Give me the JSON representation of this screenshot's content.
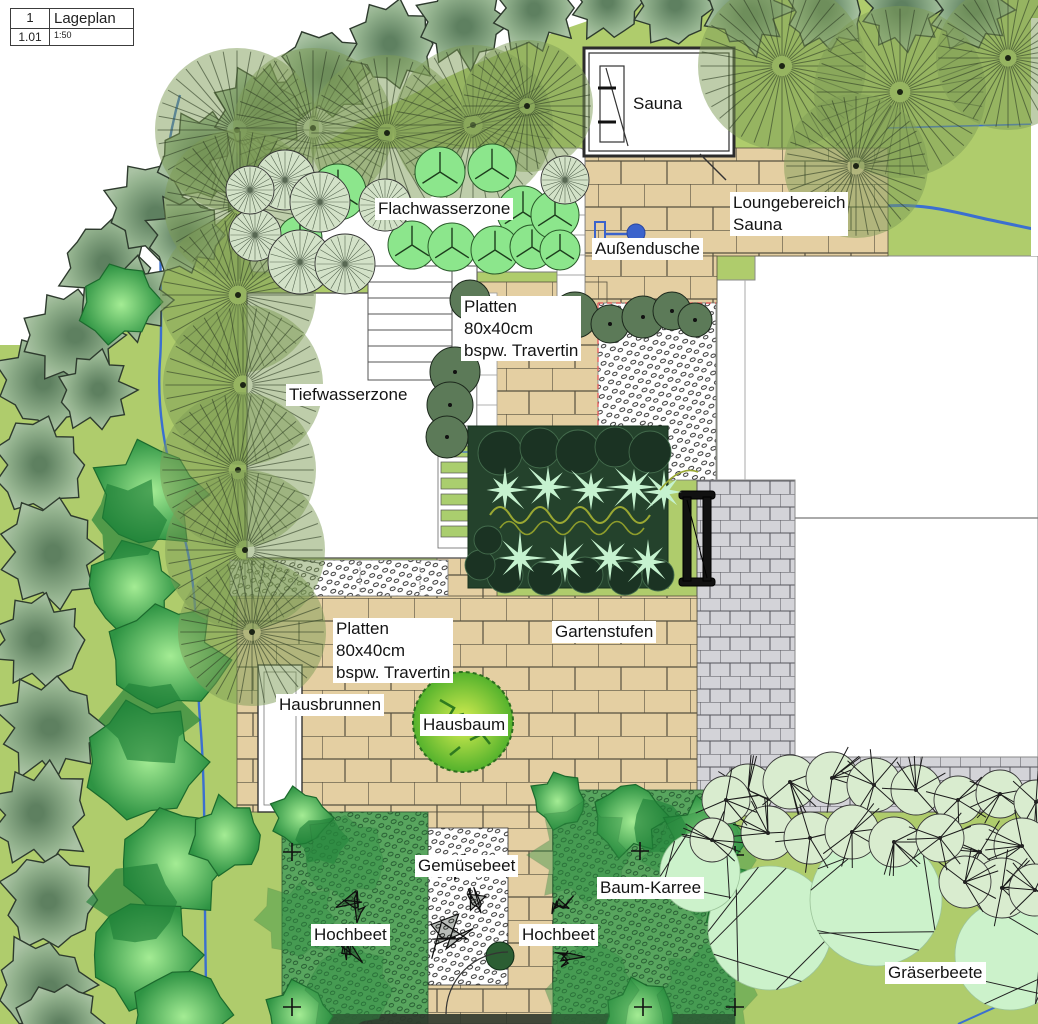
{
  "title_block": {
    "number": "1",
    "title": "Lageplan",
    "sheet": "1.01",
    "scale": "1:50"
  },
  "labels": {
    "flachwasserzone": "Flachwasserzone",
    "sauna": "Sauna",
    "loungebereich_sauna": "Loungebereich\nSauna",
    "aussendusche": "Außendusche",
    "platten_oben": "Platten\n80x40cm\nbspw. Travertin",
    "tiefwasserzone": "Tiefwasserzone",
    "gartenstufen": "Gartenstufen",
    "platten_terrasse": "Platten\n80x40cm\nbspw. Travertin",
    "hausbrunnen": "Hausbrunnen",
    "hausbaum": "Hausbaum",
    "gemuesebeet": "Gemüsebeet",
    "baum_karree": "Baum-Karree",
    "hochbeet_links": "Hochbeet",
    "hochbeet_rechts": "Hochbeet",
    "graeserbeete": "Gräserbeete"
  },
  "colors": {
    "lawn": "#afcc6c",
    "paving_tan": "#e4cfa2",
    "paving_gray": "#d4d4d8",
    "water": "#ffffff",
    "stream_blue": "#3b6fd0",
    "hedge_green": "#8fae8b",
    "shrub_green": "#3fae54",
    "fan_tree_olive": "#7d9b55",
    "planting_bed_dark": "#24422c",
    "mint_plant": "#bff2cf",
    "grasses_pale": "#d7eccd",
    "hausbaum_green": "#7ec832",
    "shower_blue": "#3b63cc"
  }
}
